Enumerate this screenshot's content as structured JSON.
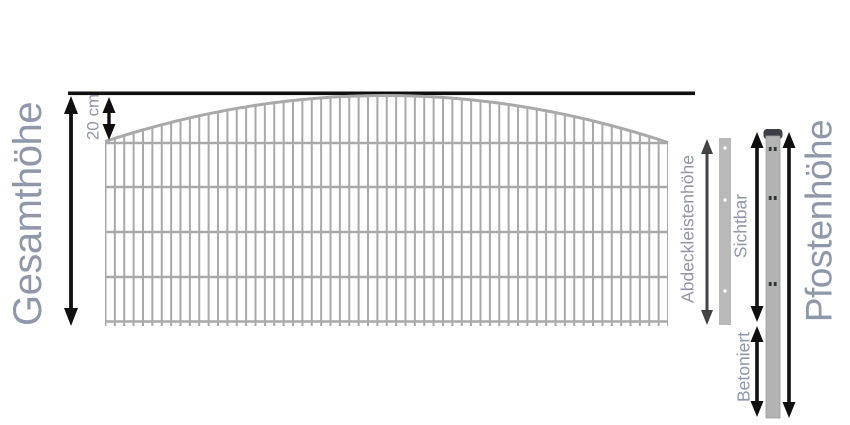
{
  "labels": {
    "gesamthoehe": "Gesamthöhe",
    "arc_height": "20 cm",
    "abdeckleistenhoehe": "Abdeckleistenhöhe",
    "sichtbar": "Sichtbar",
    "betoniert": "Betoniert",
    "pfostenhoehe": "Pfostenhöhe"
  },
  "colors": {
    "label": "#8e98aa",
    "arrow": "#101010",
    "arrow_gray": "#404347",
    "fence": "#a9a9a9",
    "strip": "#b9b9b9",
    "strip_hole": "#ffffff",
    "post": "#b3b3b3",
    "post_edge": "#9c9c9c",
    "cap": "#3c4046",
    "post_hole": "#323538"
  }
}
